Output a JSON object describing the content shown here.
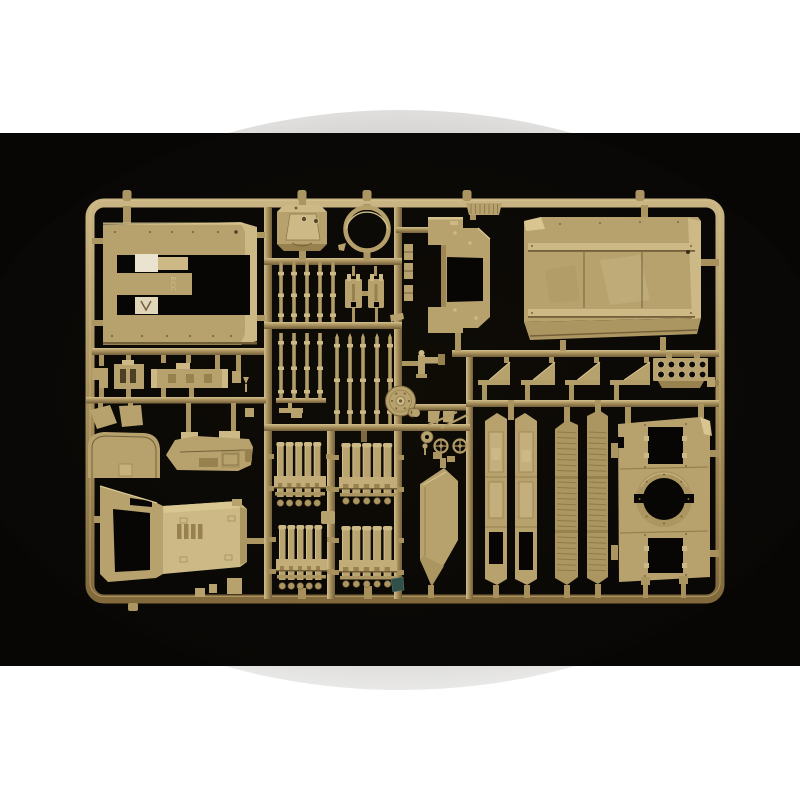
{
  "meta": {
    "description": "Product photograph of a single injection-molded model kit sprue of sand-tan plastic parts for a military vehicle kit, centered on a black background with white bands above and below the photo.",
    "photo_area": {
      "x": 0,
      "y": 133,
      "width": 800,
      "height": 533
    }
  },
  "palette": {
    "page_white": "#ffffff",
    "photo_black": "#070605",
    "tan_highlight": "#dbc994",
    "tan_light": "#cdb985",
    "tan_mid": "#b7a26e",
    "tan_base": "#ab9560",
    "tan_runner": "#a8905c",
    "tan_dark": "#97814e",
    "tan_shadow": "#73603a",
    "white_block": "#eae3cf",
    "teal": "#31504a"
  },
  "sprue": {
    "plastic_color_name": "sand tan",
    "embossed_text": "ECC",
    "parts": [
      {
        "name": "hull-roof-panel",
        "desc": "large flat panel with rectangular cut-outs, upper left"
      },
      {
        "name": "turret-hatch-octagon",
        "desc": "octagonal hatch with two periscopes"
      },
      {
        "name": "ring-part",
        "desc": "circular hoop"
      },
      {
        "name": "rod-set",
        "desc": "thin cylindrical rods with collars, two banks"
      },
      {
        "name": "pump-cans",
        "desc": "two small pronged box parts"
      },
      {
        "name": "windshield-frame",
        "desc": "frame part with rectangular window opening"
      },
      {
        "name": "vent-grille",
        "desc": "small ribbed grille on top runner"
      },
      {
        "name": "hull-deck-panel",
        "desc": "large deck panel with rails, upper right"
      },
      {
        "name": "wedge-brackets",
        "desc": "four triangular ramp brackets"
      },
      {
        "name": "ten-hole-manifold",
        "desc": "plate with 2x5 round holes"
      },
      {
        "name": "disc-hub",
        "desc": "round disc with hub on runner"
      },
      {
        "name": "machine-gun-mount",
        "desc": "small gun/periscope fitting"
      },
      {
        "name": "arched-windshield",
        "desc": "dome shaped panel"
      },
      {
        "name": "chassis-tray",
        "desc": "boat shaped tray with hatches"
      },
      {
        "name": "bumper-bar",
        "desc": "long slotted bar"
      },
      {
        "name": "mudflaps",
        "desc": "two small trapezoid flaps"
      },
      {
        "name": "cab-hood",
        "desc": "large angled cab with window opening and louvered hood"
      },
      {
        "name": "ammo-tube-racks",
        "desc": "four racks of five rounds each"
      },
      {
        "name": "side-skirt-panels",
        "desc": "two plain skirt panels with openings"
      },
      {
        "name": "louvered-skirt-panels",
        "desc": "two ribbed skirt panels"
      },
      {
        "name": "turret-ring-plate",
        "desc": "plate with large circular ring opening and two hatch openings"
      },
      {
        "name": "curved-door",
        "desc": "curved door/fender panel"
      },
      {
        "name": "handwheels",
        "desc": "two small spoked handwheels"
      }
    ],
    "frame": {
      "x": 90,
      "y": 203,
      "width": 630,
      "height": 396,
      "rx": 14,
      "bar": 9
    },
    "repeats": {
      "rods_upper": {
        "xs": [
          281,
          294,
          307,
          320,
          333
        ],
        "y1": 265,
        "y2": 322
      },
      "rods_lower_left": {
        "xs": [
          281,
          294,
          307,
          320
        ],
        "y1": 333,
        "y2": 400
      },
      "rods_lower_right": {
        "xs": [
          337,
          350,
          363,
          377,
          390
        ],
        "y1": 333,
        "y2": 424
      },
      "tube_clusters": [
        {
          "x": 274,
          "y": 442,
          "w": 52,
          "h": 65
        },
        {
          "x": 339,
          "y": 443,
          "w": 58,
          "h": 62
        },
        {
          "x": 276,
          "y": 525,
          "w": 51,
          "h": 65
        },
        {
          "x": 339,
          "y": 526,
          "w": 58,
          "h": 62
        }
      ],
      "wedges": {
        "baseY": 380,
        "plateH": 5,
        "apexH": 18,
        "items": [
          {
            "x": 478,
            "w": 32
          },
          {
            "x": 521,
            "w": 34
          },
          {
            "x": 565,
            "w": 35
          },
          {
            "x": 610,
            "w": 40
          }
        ]
      },
      "hole_grid": {
        "cx0": 661,
        "dx": 10.4,
        "cy0": 364.5,
        "dy": 10,
        "cols": 5,
        "rows": 2,
        "r": 3.3
      },
      "skirt_ribs": {
        "panels": [
          {
            "x": 557,
            "w": 19.5
          },
          {
            "x": 588.5,
            "w": 18
          }
        ],
        "rows": [
          [
            432,
            473
          ],
          [
            482,
            527
          ],
          [
            537,
            573
          ]
        ],
        "step": 5.5
      },
      "disc_bolts": {
        "cx": 400.5,
        "cy": 401,
        "r": 8.5,
        "n": 6,
        "dot": 1.1
      },
      "plate_ring_bolts": {
        "cx": 664,
        "cy": 499,
        "r": 24.5,
        "n": 8,
        "dot": 1
      },
      "panel_rivets": [
        [
          115,
          232
        ],
        [
          150,
          232
        ],
        [
          172,
          232
        ],
        [
          193,
          232
        ],
        [
          218,
          232
        ],
        [
          112,
          336
        ],
        [
          142,
          336
        ],
        [
          167,
          336
        ],
        [
          190,
          336
        ],
        [
          213,
          336
        ],
        [
          231,
          336
        ]
      ],
      "roof_rivets": [
        [
          560,
          224
        ],
        [
          600,
          223
        ],
        [
          640,
          222
        ],
        [
          678,
          222
        ],
        [
          532,
          246
        ],
        [
          691,
          246
        ],
        [
          532,
          313
        ],
        [
          691,
          313
        ]
      ],
      "plate_rivets": [
        [
          645,
          425
        ],
        [
          686,
          424
        ],
        [
          645,
          467
        ],
        [
          686,
          466
        ],
        [
          645,
          535
        ],
        [
          686,
          534
        ],
        [
          645,
          576
        ],
        [
          686,
          575
        ]
      ],
      "window_bumps": [
        [
          455,
          233
        ],
        [
          470,
          243
        ],
        [
          455,
          310
        ],
        [
          476,
          318
        ]
      ],
      "top_nubs": [
        127,
        302,
        367,
        467,
        640
      ],
      "bottom_stubs": [
        [
          298,
          588,
          8,
          11
        ],
        [
          364,
          586,
          8,
          13
        ],
        [
          493,
          585,
          6,
          13
        ],
        [
          524,
          585,
          6,
          13
        ],
        [
          564,
          585,
          6,
          13
        ],
        [
          595,
          584,
          6,
          14
        ],
        [
          643,
          585,
          5,
          13
        ],
        [
          681,
          584,
          5,
          14
        ],
        [
          428,
          585,
          6,
          13
        ]
      ],
      "right_gates": [
        [
          701,
          259,
          18,
          7
        ],
        [
          708,
          380,
          11,
          6
        ],
        [
          710,
          450,
          9,
          7
        ],
        [
          710,
          550,
          9,
          7
        ]
      ]
    }
  }
}
